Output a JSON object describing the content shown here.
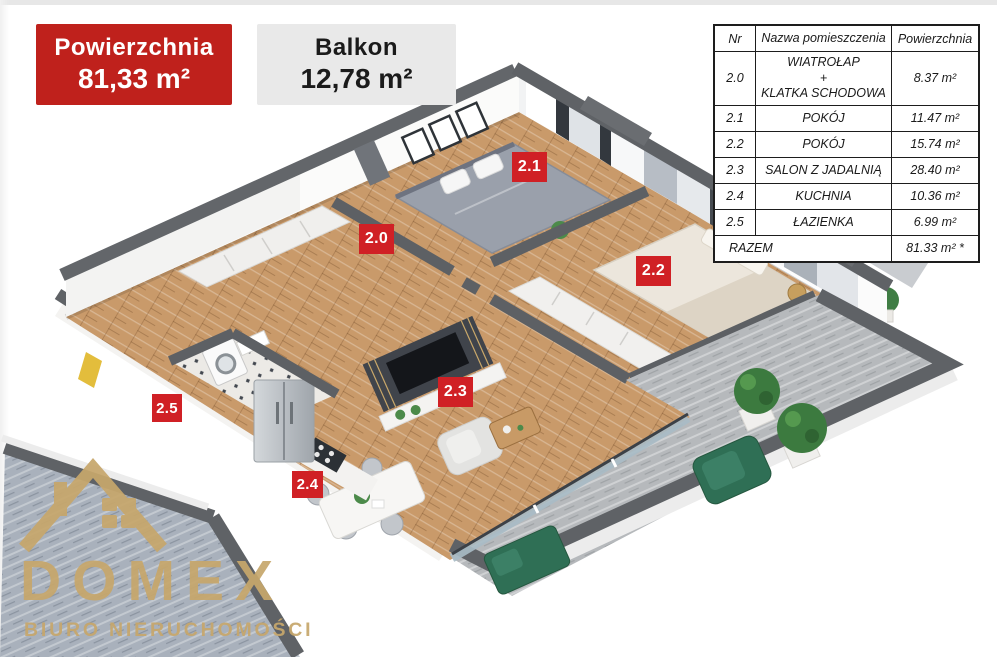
{
  "badges": {
    "area": {
      "label": "Powierzchnia",
      "value": "81,33 m²"
    },
    "balcony": {
      "label": "Balkon",
      "value": "12,78 m²"
    }
  },
  "rooms_table": {
    "headers": [
      "Nr",
      "Nazwa pomieszczenia",
      "Powierzchnia"
    ],
    "rows": [
      {
        "nr": "2.0",
        "name": "WIATROŁAP\n+\nKLATKA SCHODOWA",
        "area": "8.37 m²"
      },
      {
        "nr": "2.1",
        "name": "POKÓJ",
        "area": "11.47 m²"
      },
      {
        "nr": "2.2",
        "name": "POKÓJ",
        "area": "15.74 m²"
      },
      {
        "nr": "2.3",
        "name": "SALON Z JADALNIĄ",
        "area": "28.40 m²"
      },
      {
        "nr": "2.4",
        "name": "KUCHNIA",
        "area": "10.36 m²"
      },
      {
        "nr": "2.5",
        "name": "ŁAZIENKA",
        "area": "6.99 m²"
      }
    ],
    "total_label": "RAZEM",
    "total_area": "81.33 m² *"
  },
  "plan_labels": [
    {
      "id": "2.0"
    },
    {
      "id": "2.1"
    },
    {
      "id": "2.2"
    },
    {
      "id": "2.3"
    },
    {
      "id": "2.4"
    },
    {
      "id": "2.5"
    }
  ],
  "logo": {
    "name": "DOMEX",
    "tagline": "BIURO NIERUCHOMOŚCI"
  },
  "colors": {
    "badge_red": "#bf211c",
    "label_red": "#d02025",
    "badge_gray": "#e9e9e9",
    "logo_gold": "#c7a76c",
    "wall_dark": "#5f6266",
    "wood_floor": "#c99a6a"
  }
}
